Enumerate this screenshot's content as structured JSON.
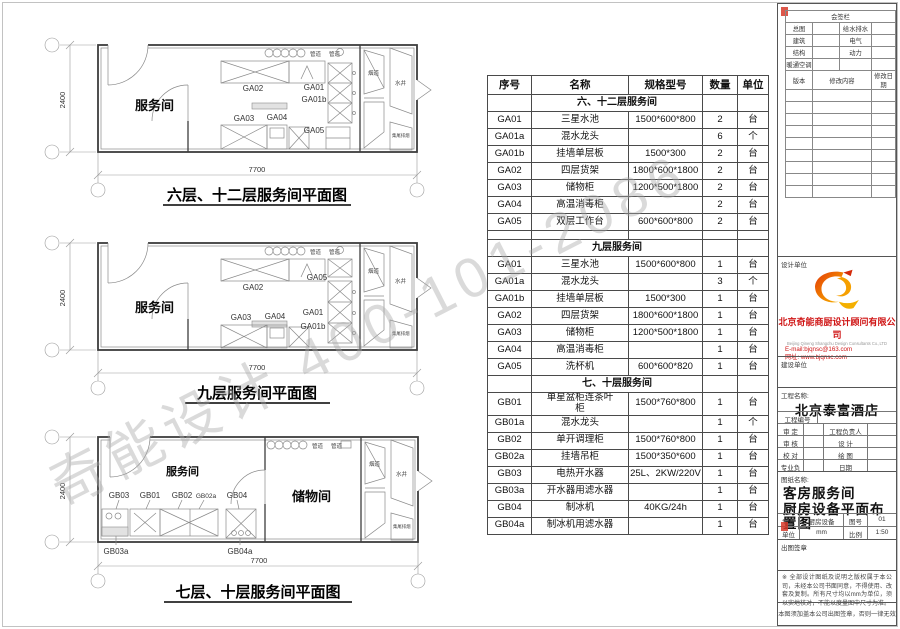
{
  "watermark": {
    "text": "奇能设计 400-101-2086"
  },
  "plans": [
    {
      "title": "六层、十二层服务间平面图",
      "rooms": [
        "服务间"
      ],
      "dims": {
        "width": "7700",
        "height": "2400"
      },
      "pipes": [
        "管道",
        "管道"
      ],
      "shafts": [
        "烟道",
        "水井",
        "集尾排烟"
      ],
      "labels": [
        "GA02",
        "GA01",
        "GA01b",
        "GA03",
        "GA04",
        "GA05"
      ]
    },
    {
      "title": "九层服务间平面图",
      "rooms": [
        "服务间"
      ],
      "dims": {
        "width": "7700",
        "height": "2400"
      },
      "pipes": [
        "管道",
        "管道"
      ],
      "shafts": [
        "烟道",
        "水井",
        "集尾排烟"
      ],
      "labels": [
        "GA02",
        "GA05",
        "GA01",
        "GA01b",
        "GA03",
        "GA04"
      ]
    },
    {
      "title": "七层、十层服务间平面图",
      "rooms": [
        "服务间",
        "储物间"
      ],
      "dims": {
        "width": "7700",
        "height": "2400"
      },
      "pipes": [
        "管道",
        "管道"
      ],
      "shafts": [
        "烟道",
        "水井",
        "集尾排烟"
      ],
      "labels": [
        "GB03",
        "GB01",
        "GB02",
        "GB02a",
        "GB04",
        "GB03a",
        "GB04a"
      ]
    }
  ],
  "table": {
    "headers": [
      "序号",
      "名称",
      "规格型号",
      "数量",
      "单位"
    ],
    "rows": [
      {
        "type": "section",
        "label": "六、十二层服务间"
      },
      {
        "type": "item",
        "code": "GA01",
        "name": "三星水池",
        "spec": "1500*600*800",
        "qty": "2",
        "unit": "台"
      },
      {
        "type": "item",
        "code": "GA01a",
        "name": "混水龙头",
        "spec": "",
        "qty": "6",
        "unit": "个"
      },
      {
        "type": "item",
        "code": "GA01b",
        "name": "挂墙单层板",
        "spec": "1500*300",
        "qty": "2",
        "unit": "台"
      },
      {
        "type": "item",
        "code": "GA02",
        "name": "四层货架",
        "spec": "1800*600*1800",
        "qty": "2",
        "unit": "台"
      },
      {
        "type": "item",
        "code": "GA03",
        "name": "储物柜",
        "spec": "1200*500*1800",
        "qty": "2",
        "unit": "台"
      },
      {
        "type": "item",
        "code": "GA04",
        "name": "高温消毒柜",
        "spec": "",
        "qty": "2",
        "unit": "台"
      },
      {
        "type": "item",
        "code": "GA05",
        "name": "双层工作台",
        "spec": "600*600*800",
        "qty": "2",
        "unit": "台"
      },
      {
        "type": "blank"
      },
      {
        "type": "section",
        "label": "九层服务间"
      },
      {
        "type": "item",
        "code": "GA01",
        "name": "三星水池",
        "spec": "1500*600*800",
        "qty": "1",
        "unit": "台"
      },
      {
        "type": "item",
        "code": "GA01a",
        "name": "混水龙头",
        "spec": "",
        "qty": "3",
        "unit": "个"
      },
      {
        "type": "item",
        "code": "GA01b",
        "name": "挂墙单层板",
        "spec": "1500*300",
        "qty": "1",
        "unit": "台"
      },
      {
        "type": "item",
        "code": "GA02",
        "name": "四层货架",
        "spec": "1800*600*1800",
        "qty": "1",
        "unit": "台"
      },
      {
        "type": "item",
        "code": "GA03",
        "name": "储物柜",
        "spec": "1200*500*1800",
        "qty": "1",
        "unit": "台"
      },
      {
        "type": "item",
        "code": "GA04",
        "name": "高温消毒柜",
        "spec": "",
        "qty": "1",
        "unit": "台"
      },
      {
        "type": "item",
        "code": "GA05",
        "name": "洗杯机",
        "spec": "600*600*820",
        "qty": "1",
        "unit": "台"
      },
      {
        "type": "section",
        "label": "七、十层服务间"
      },
      {
        "type": "item",
        "code": "GB01",
        "name": "单星盆柜连茶叶\n柜",
        "spec": "1500*760*800",
        "qty": "1",
        "unit": "台"
      },
      {
        "type": "item",
        "code": "GB01a",
        "name": "混水龙头",
        "spec": "",
        "qty": "1",
        "unit": "个"
      },
      {
        "type": "item",
        "code": "GB02",
        "name": "单开调理柜",
        "spec": "1500*760*800",
        "qty": "1",
        "unit": "台"
      },
      {
        "type": "item",
        "code": "GB02a",
        "name": "挂墙吊柜",
        "spec": "1500*350*600",
        "qty": "1",
        "unit": "台"
      },
      {
        "type": "item",
        "code": "GB03",
        "name": "电热开水器",
        "spec": "25L、2KW/220V",
        "qty": "1",
        "unit": "台"
      },
      {
        "type": "item",
        "code": "GB03a",
        "name": "开水器用滤水器",
        "spec": "",
        "qty": "1",
        "unit": "台"
      },
      {
        "type": "item",
        "code": "GB04",
        "name": "制冰机",
        "spec": "40KG/24h",
        "qty": "1",
        "unit": "台"
      },
      {
        "type": "item",
        "code": "GB04a",
        "name": "制冰机用滤水器",
        "spec": "",
        "qty": "1",
        "unit": "台"
      }
    ]
  },
  "titleblock": {
    "sign_title": "会签栏",
    "sign_rows": [
      [
        "总图",
        "给水排水"
      ],
      [
        "建筑",
        "电气"
      ],
      [
        "结构",
        "动力"
      ],
      [
        "暖通空调",
        ""
      ]
    ],
    "rev_headers": [
      "版本",
      "修改内容",
      "修改日期"
    ],
    "design_unit_label": "设计单位",
    "company_cn": "北京奇能商厨设计顾问有限公司",
    "company_en": "Beijing Qineng Shangchu Design Consultants Co.,LTD",
    "email": "E-mail:bjqnsc@163.com",
    "website": "网址: www.bjqnsc.com",
    "build_unit_label": "建设单位",
    "project_label": "工程名称:",
    "project_name": "北京泰富酒店",
    "project_no_label": "工程编号",
    "fields": [
      [
        "审 定",
        "工程负责人"
      ],
      [
        "审 核",
        "设 计"
      ],
      [
        "校 对",
        "绘 图"
      ],
      [
        "专业负责人",
        "日期"
      ]
    ],
    "drawing_label": "图纸名称:",
    "drawing_name_1": "客房服务间",
    "drawing_name_2": "厨房设备平面布置图",
    "meta": [
      [
        "专业",
        "厨房设备",
        "图号",
        "01"
      ],
      [
        "单位",
        "mm",
        "比例",
        "1:50"
      ]
    ],
    "seal_label": "出图签章",
    "note1": "※ 全部设计图纸及说明之版权属于本公司，未经本公司书面同意，不得使用、改套及复制。所有尺寸均以mm为单位，须以实地核对，不能以度量图中尺寸为准。",
    "note2": "本图须加盖本公司出图签章，否则一律无效"
  }
}
